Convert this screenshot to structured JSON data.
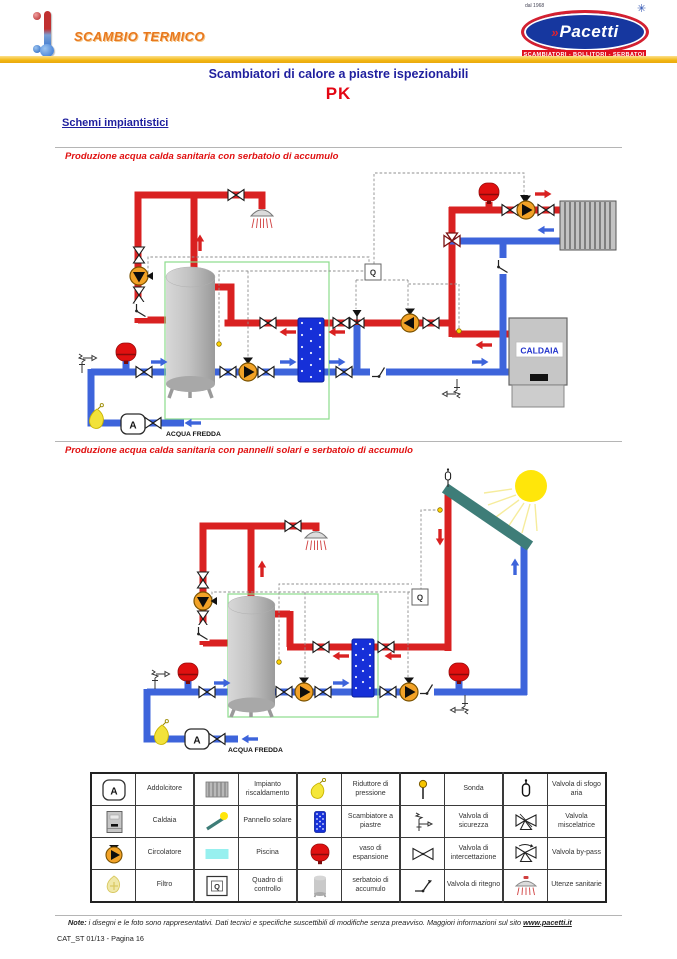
{
  "header": {
    "brand_left": "SCAMBIO TERMICO",
    "logo": {
      "name": "Pacetti",
      "chevron": "»",
      "since": "dal 1968",
      "tagline": "SCAMBIATORI - BOLLITORI - SERBATOI"
    }
  },
  "titles": {
    "main": "Scambiatori di calore a piastre ispezionabili",
    "model": "PK",
    "section": "Schemi impiantistici"
  },
  "diagram1": {
    "caption": "Produzione acqua calda sanitaria con serbatoio di accumulo",
    "boiler_label": "CALDAIA",
    "control_label": "Q",
    "softener_label": "A",
    "cold_water_label": "ACQUA FREDDA"
  },
  "diagram2": {
    "caption": "Produzione acqua calda sanitaria con pannelli solari e serbatoio di accumulo",
    "control_label": "Q",
    "softener_label": "A",
    "cold_water_label": "ACQUA FREDDA"
  },
  "legend": {
    "softener_letter": "A",
    "control_letter": "Q",
    "items": [
      {
        "icon": "softener-icon",
        "label": "Addolcitore"
      },
      {
        "icon": "radiator-icon",
        "label": "Impianto riscaldamento"
      },
      {
        "icon": "pressure-reducer-icon",
        "label": "Riduttore di pressione"
      },
      {
        "icon": "probe-icon",
        "label": "Sonda"
      },
      {
        "icon": "air-vent-valve-icon",
        "label": "Valvola di sfogo aria"
      },
      {
        "icon": "boiler-icon",
        "label": "Caldaia"
      },
      {
        "icon": "solar-panel-icon",
        "label": "Pannello solare"
      },
      {
        "icon": "plate-exchanger-icon",
        "label": "Scambiatore a piastre"
      },
      {
        "icon": "safety-valve-icon",
        "label": "Valvola di sicurezza"
      },
      {
        "icon": "mixing-valve-icon",
        "label": "Valvola miscelatrice"
      },
      {
        "icon": "pump-icon",
        "label": "Circolatore"
      },
      {
        "icon": "pool-icon",
        "label": "Piscina"
      },
      {
        "icon": "expansion-vessel-icon",
        "label": "vaso di espansione"
      },
      {
        "icon": "shutoff-valve-icon",
        "label": "Valvola di intercettazione"
      },
      {
        "icon": "bypass-valve-icon",
        "label": "Valvola by-pass"
      },
      {
        "icon": "filter-icon",
        "label": "Filtro"
      },
      {
        "icon": "control-panel-icon",
        "label": "Quadro di controllo"
      },
      {
        "icon": "storage-tank-icon",
        "label": "serbatoio di accumulo"
      },
      {
        "icon": "check-valve-icon",
        "label": "Valvola di ritegno"
      },
      {
        "icon": "sanitary-icon",
        "label": "Utenze sanitarie"
      }
    ]
  },
  "footer": {
    "note_label": "Note:",
    "note_text": " i disegni e le foto sono rappresentativi. Dati tecnici e specifiche suscettibili di modifiche senza preavviso. Maggiori informazioni sul sito ",
    "site": "www.pacetti.it",
    "page_code": "CAT_ST 01/13 - Pagina 16"
  },
  "colors": {
    "pipe_hot": "#d92121",
    "pipe_cold": "#3d64db",
    "accent_red": "#e30613",
    "navy": "#1f1f9e",
    "gold": "#f2b713",
    "panel_teal": "#3e7d78"
  }
}
